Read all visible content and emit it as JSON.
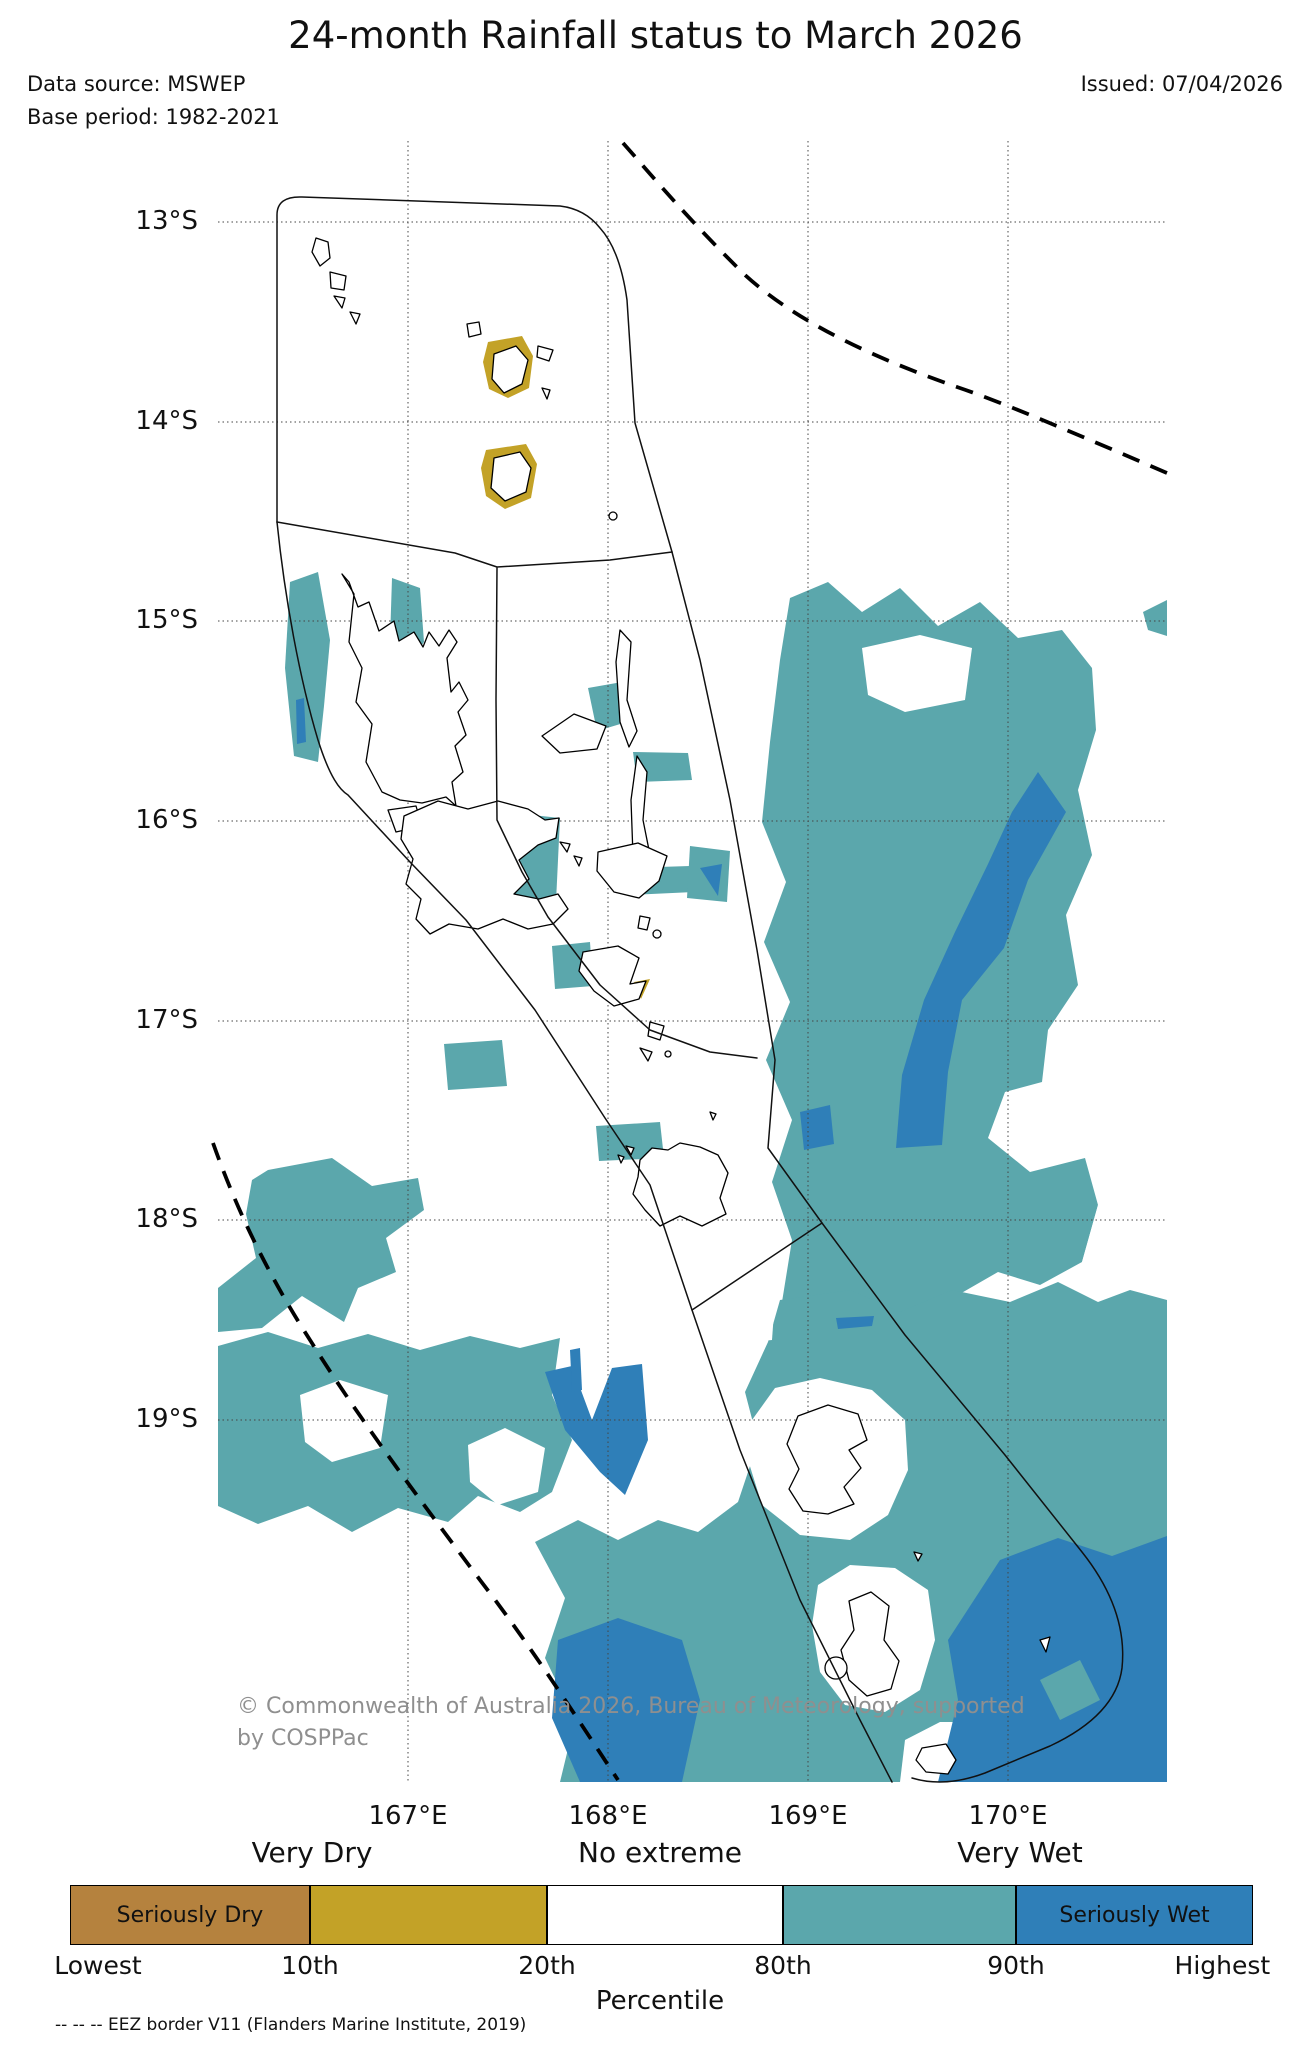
{
  "header": {
    "title": "24-month Rainfall status to March 2026",
    "data_source": "Data source: MSWEP",
    "base_period": "Base period: 1982-2021",
    "issued": "Issued: 07/04/2026"
  },
  "map": {
    "lat_labels": [
      "13°S",
      "14°S",
      "15°S",
      "16°S",
      "17°S",
      "18°S",
      "19°S"
    ],
    "lon_labels": [
      "167°E",
      "168°E",
      "169°E",
      "170°E"
    ],
    "copyright_line1": "© Commonwealth of Australia 2026, Bureau of Meteorology, supported",
    "copyright_line2": "by COSPPac"
  },
  "legend": {
    "categories": [
      "Very Dry",
      "No extreme",
      "Very Wet"
    ],
    "seriously_dry": "Seriously Dry",
    "seriously_wet": "Seriously Wet",
    "percentiles": [
      "Lowest",
      "10th",
      "20th",
      "80th",
      "90th",
      "Highest"
    ],
    "axis_label": "Percentile",
    "colors": {
      "seriously_dry": "#b5823e",
      "very_dry": "#c3a227",
      "no_extreme": "#ffffff",
      "very_wet": "#5ba7ac",
      "seriously_wet": "#2f7fb8"
    }
  },
  "footnote": {
    "eez": "-- -- -- EEZ border V11 (Flanders Marine Institute, 2019)"
  }
}
